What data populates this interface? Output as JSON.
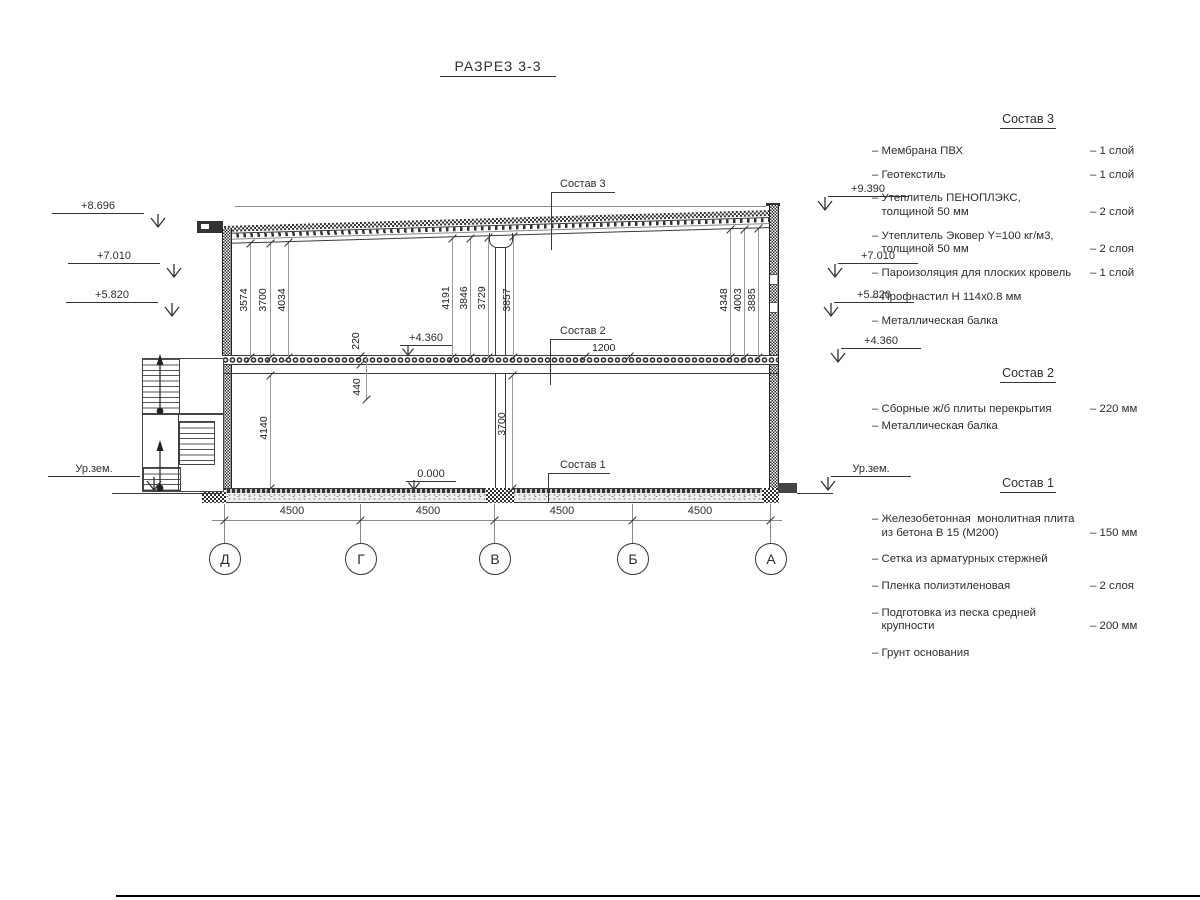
{
  "title": "РАЗРЕЗ 3-3",
  "colors": {
    "line": "#3a3a3a",
    "dim_line": "#9a9a9a",
    "background": "#ffffff"
  },
  "drawing": {
    "levels_left": [
      "+8.696",
      "+7.010",
      "+5.820",
      "Ур.зем."
    ],
    "levels_right": [
      "+9.390",
      "+7.010",
      "+5.820",
      "+4.360",
      "Ур.зем."
    ],
    "upper_dims": [
      "3574",
      "3700",
      "4034",
      "4191",
      "3846",
      "3729",
      "3857",
      "4348",
      "4003",
      "3885"
    ],
    "slab_thickness": "220",
    "beam_height": "440",
    "floor_height": "4140",
    "clear_height": "3700",
    "slab_level": "+4.360",
    "floor_level": "0.000",
    "dim_1200": "1200",
    "callout_roof": "Состав 3",
    "callout_slab": "Состав 2",
    "callout_floor": "Состав 1",
    "bay_dims": [
      "4500",
      "4500",
      "4500",
      "4500"
    ],
    "axes": [
      "Д",
      "Г",
      "В",
      "Б",
      "А"
    ]
  },
  "legend": {
    "sections": [
      {
        "title": "Состав 3",
        "items": [
          {
            "name": "– Мембрана ПВХ",
            "qty": "– 1 слой"
          },
          {
            "name": "– Геотекстиль",
            "qty": "– 1 слой"
          },
          {
            "name": "– Утеплитель ПЕНОПЛЭКС,\n   толщиной 50 мм",
            "qty": "– 2 слой"
          },
          {
            "name": "– Утеплитель Эковер Y=100 кг/м3,\n   толщиной 50 мм",
            "qty": "– 2 слоя"
          },
          {
            "name": "– Пароизоляция для плоских кровель",
            "qty": "– 1 слой"
          },
          {
            "name": "– Профнастил Н 114х0.8 мм",
            "qty": ""
          },
          {
            "name": "– Металлическая балка",
            "qty": ""
          }
        ]
      },
      {
        "title": "Состав 2",
        "items": [
          {
            "name": "– Сборные ж/б плиты перекрытия",
            "qty": "– 220 мм"
          },
          {
            "name": "– Металлическая балка",
            "qty": ""
          }
        ]
      },
      {
        "title": "Состав 1",
        "items": [
          {
            "name": "– Железобетонная  монолитная плита\n   из бетона В 15 (М200)",
            "qty": "– 150 мм"
          },
          {
            "name": "– Сетка из арматурных стержней",
            "qty": ""
          },
          {
            "name": "– Пленка полиэтиленовая",
            "qty": "–  2 слоя"
          },
          {
            "name": "– Подготовка из песка средней\n   крупности",
            "qty": "– 200 мм"
          },
          {
            "name": "– Грунт основания",
            "qty": ""
          }
        ]
      }
    ]
  }
}
